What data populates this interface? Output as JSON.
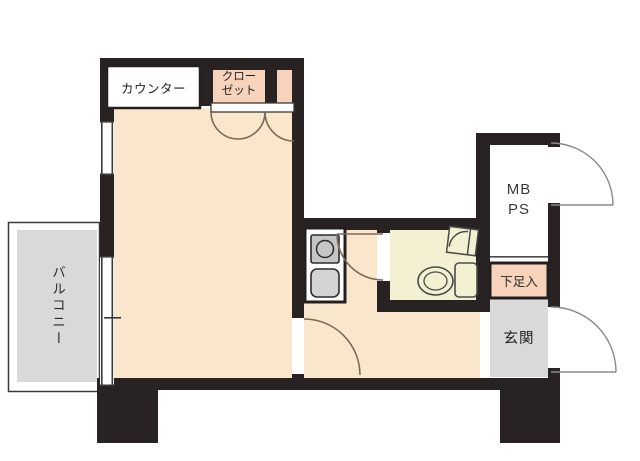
{
  "floorplan": {
    "labels": {
      "counter": "カウンター",
      "closet_line1": "クロー",
      "closet_line2": "ゼット",
      "balcony": "バルコニー",
      "meter_box_line1": "MB",
      "meter_box_line2": "PS",
      "shoe_cabinet": "下足入",
      "entrance": "玄関"
    },
    "colors": {
      "wall": "#282223",
      "room_floor": "#fae7cb",
      "closet_fill": "#f8d3bb",
      "balcony_floor": "#d9d9db",
      "entrance_floor": "#d9d9db",
      "bathroom_floor": "#f4f1d3",
      "shoe_cabinet_fill": "#f8d3bb",
      "fixture_gray": "#c9c9c9"
    }
  }
}
